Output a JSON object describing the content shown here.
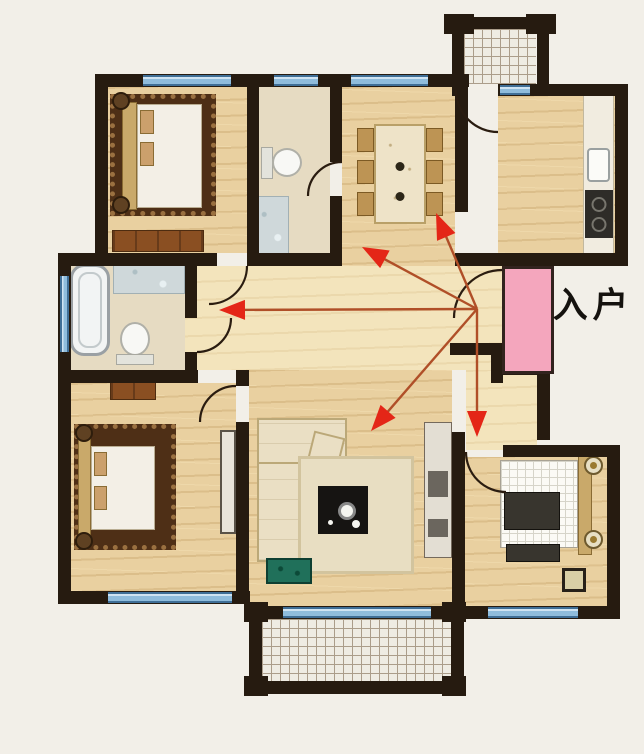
{
  "entrance": {
    "label": "入户"
  },
  "palette": {
    "bg": "#f2efe8",
    "wall": "#261b10",
    "wood": "#e9d0a0",
    "hall": "#f3e4bc",
    "bath_floor": "#e6dbc2",
    "window_blue": "#8fbcdc",
    "window_hi": "#cfe3f2",
    "window_edge": "#3f6e96",
    "tile_bg": "#efece3",
    "tile_line": "#ab9d8a",
    "door_pink": "#f4a6bd",
    "arrow_head": "#e42617",
    "arrow_line": "#b04f28",
    "rug_dark": "#4e2f16",
    "rug_trim": "#9a7040",
    "furniture_brown": "#8a4f22",
    "sofa_cream": "#eadfc4",
    "plant_green": "#20705a",
    "table_dark": "#161412",
    "bed_white": "#f3efe6",
    "headboard_tan": "#c9a96a",
    "counter_white": "#f1ece0",
    "stove_dark": "#2e2c28",
    "label_color": "#15120e"
  },
  "arrows": {
    "origin": {
      "x": 477,
      "y": 309
    },
    "targets": [
      {
        "name": "arrow-to-dining-room",
        "x": 436,
        "y": 213
      },
      {
        "name": "arrow-to-north-hall",
        "x": 362,
        "y": 247
      },
      {
        "name": "arrow-to-west-bathroom",
        "x": 219,
        "y": 310
      },
      {
        "name": "arrow-to-living-room",
        "x": 371,
        "y": 431
      },
      {
        "name": "arrow-to-south-bedroom",
        "x": 477,
        "y": 437
      }
    ]
  }
}
